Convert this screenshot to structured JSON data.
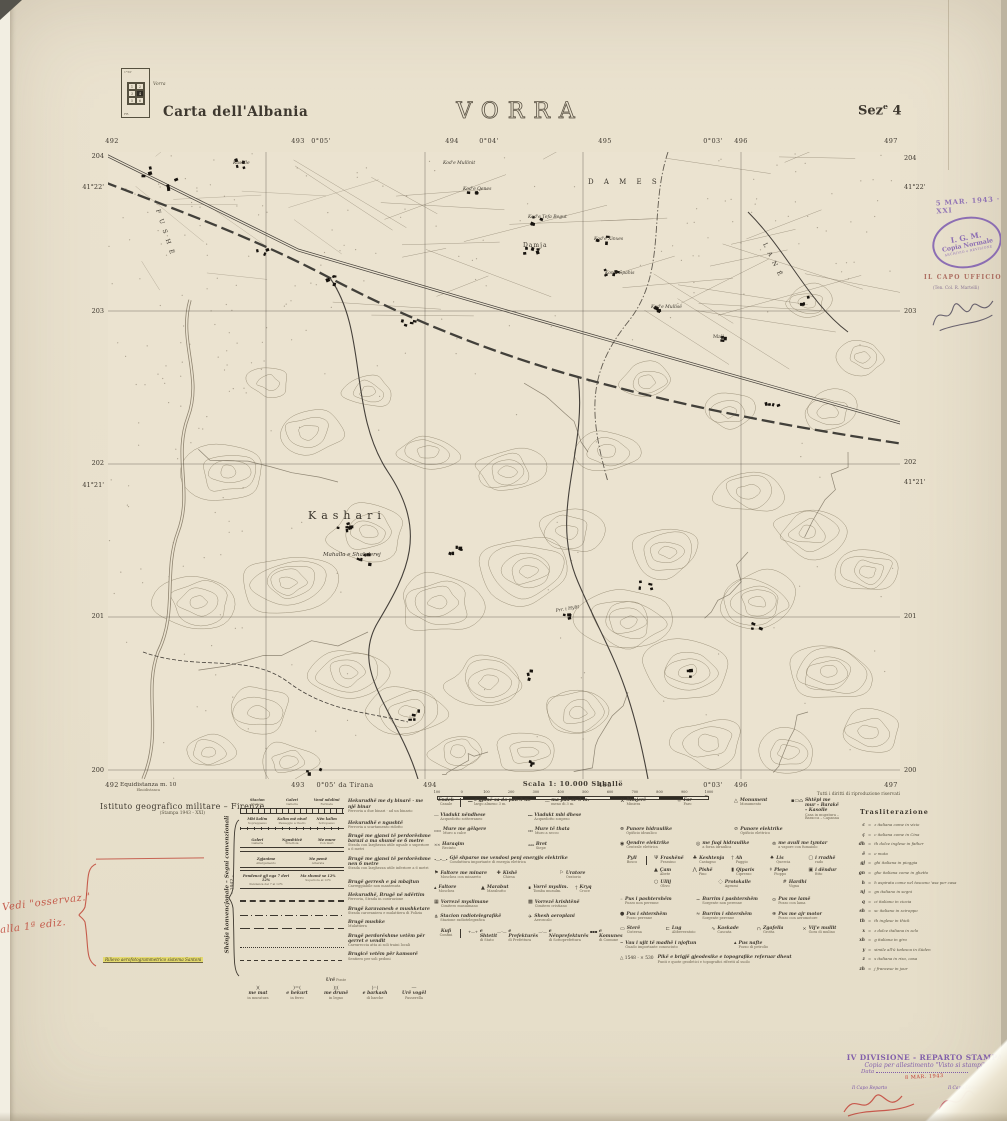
{
  "header": {
    "series_title": "Carta dell'Albania",
    "sheet_title": "VORRA",
    "sez_label": "Sez",
    "sez_sup": "e",
    "sez_num": "4",
    "index": {
      "label": "Vorra",
      "cells": [
        "1",
        "2",
        "3",
        "4",
        "5",
        "6"
      ],
      "selected": "4",
      "corner_top": "1°50'",
      "corner_bottom": "FR."
    }
  },
  "map_frame": {
    "top_labels": [
      {
        "t": "492",
        "x": 112
      },
      {
        "t": "493",
        "x": 298
      },
      {
        "t": "0°05'",
        "x": 321
      },
      {
        "t": "494",
        "x": 452
      },
      {
        "t": "0°04'",
        "x": 489
      },
      {
        "t": "495",
        "x": 605
      },
      {
        "t": "0°03'",
        "x": 713
      },
      {
        "t": "496",
        "x": 741
      },
      {
        "t": "497",
        "x": 891
      }
    ],
    "bottom_labels": [
      {
        "t": "492",
        "x": 112
      },
      {
        "t": "493",
        "x": 298
      },
      {
        "t": "0°05' da Tirana",
        "x": 345
      },
      {
        "t": "494",
        "x": 430
      },
      {
        "t": "495",
        "x": 605
      },
      {
        "t": "0°03'",
        "x": 713
      },
      {
        "t": "496",
        "x": 741
      },
      {
        "t": "497",
        "x": 891
      }
    ],
    "left_labels": [
      {
        "t": "204",
        "y": 152
      },
      {
        "t": "41°22'",
        "y": 183
      },
      {
        "t": "203",
        "y": 307
      },
      {
        "t": "202",
        "y": 459
      },
      {
        "t": "41°21'",
        "y": 481
      },
      {
        "t": "201",
        "y": 612
      },
      {
        "t": "200",
        "y": 766
      }
    ],
    "right_labels": [
      {
        "t": "204",
        "y": 154
      },
      {
        "t": "41°22'",
        "y": 183
      },
      {
        "t": "203",
        "y": 307
      },
      {
        "t": "202",
        "y": 458
      },
      {
        "t": "41°21'",
        "y": 478
      },
      {
        "t": "201",
        "y": 612
      },
      {
        "t": "200",
        "y": 766
      }
    ],
    "equidistance": "Equidistanza m. 10",
    "equidistance_sub": "Ekuidistanca",
    "scale_label": "Scala 1: 10.000 Shkallë",
    "scale_ticks": [
      "100",
      "0",
      "100",
      "200",
      "300",
      "400",
      "500",
      "600",
      "700",
      "800",
      "900",
      "1000 m."
    ],
    "rights": "Tutti i diritti di riproduzione riservati"
  },
  "map_labels": [
    {
      "t": "Kasolle",
      "x": 125,
      "y": 12,
      "s": 4.5,
      "it": true
    },
    {
      "t": "Kod'e Mullinit",
      "x": 335,
      "y": 12,
      "s": 4.5,
      "it": true
    },
    {
      "t": "Kod'e Qenes",
      "x": 355,
      "y": 38,
      "s": 4.5,
      "it": true
    },
    {
      "t": "Kod'e Tefa Begut",
      "x": 420,
      "y": 66,
      "s": 4.5,
      "it": true
    },
    {
      "t": "Damja",
      "x": 415,
      "y": 95,
      "s": 6,
      "sp": 1
    },
    {
      "t": "Kod'e Xinxes",
      "x": 486,
      "y": 88,
      "s": 4.5,
      "it": true
    },
    {
      "t": "Kon'e Spahis",
      "x": 497,
      "y": 122,
      "s": 4.5,
      "it": true
    },
    {
      "t": "Kod'e Mullisë",
      "x": 543,
      "y": 156,
      "s": 4.5,
      "it": true
    },
    {
      "t": "Mali",
      "x": 605,
      "y": 186,
      "s": 5
    },
    {
      "t": "D A M E S",
      "x": 480,
      "y": 32,
      "s": 7,
      "sp": 4
    },
    {
      "t": "F U S H Ë",
      "x": 48,
      "y": 58,
      "s": 6,
      "sp": 2,
      "rot": 72
    },
    {
      "t": "L A N Ë",
      "x": 655,
      "y": 92,
      "s": 6,
      "sp": 2,
      "rot": 64
    },
    {
      "t": "Kashari",
      "x": 200,
      "y": 367,
      "s": 11,
      "sp": 5
    },
    {
      "t": "Mahalla e Shabderej",
      "x": 215,
      "y": 404,
      "s": 5.5,
      "it": true
    },
    {
      "t": "Prr. i Hylit",
      "x": 448,
      "y": 460,
      "s": 4.5,
      "it": true,
      "rot": -10
    }
  ],
  "stamps": {
    "date_stamp": "5 MAR. 1943 · XXI",
    "oval_line1": "I. G. M.",
    "oval_line2": "Copia Normale",
    "oval_line3": "ARCHIVIO e REVISIONE",
    "capo_ufficio": "IL CAPO UFFICIO",
    "capo_ufficio_sub": "(Ten. Col. R. Martelli)",
    "print_line1": "IV DIVISIONE - REPARTO STAMPA",
    "print_line2": "Copia per allestimento \"Visto si stampi\"",
    "print_line3": "Data",
    "print_date": "8 MAR. 1943",
    "capo_reparto": "Il Capo Reparto",
    "capo_divisione": "Il Capo Divisione"
  },
  "publisher": {
    "line1": "Istituto geografico militare – Firenze",
    "line2": "(Stampa 1943 - XXI)"
  },
  "annotations": {
    "red_note_line1": "Vedi \"osservaz.\"",
    "red_note_line2": "alla 1ª ediz.",
    "yellow_note": "Rilievo aerofotogrammetrico sistema Santoni"
  },
  "legend": {
    "side_label": "Shënja konvencjonale – Segni convenzionali",
    "side_label2": "– 1942 –",
    "col1": [
      {
        "sym": "rail2",
        "marks": [
          {
            "a": "Stacion",
            "i": "Stazione"
          },
          {
            "a": "Galeri",
            "i": "Galleria"
          },
          {
            "a": "Vend ndalimi",
            "i": "Fermata"
          }
        ],
        "desc": {
          "a": "Hekurudhë me dy binarë · me një binar",
          "i": "Ferrovia a due binari · ad un binario"
        }
      },
      {
        "sym": "rail1",
        "marks": [
          {
            "a": "Mbi kalim",
            "i": "Soprappasso"
          },
          {
            "a": "Kalim më nivel",
            "i": "Passaggio a livello"
          },
          {
            "a": "Nën kalim",
            "i": "Sottopasso"
          }
        ],
        "desc": {
          "a": "Hekurudhë e ngushtë",
          "i": "Ferrovia a scartamento ridotto"
        }
      },
      {
        "sym": "road6",
        "marks": [
          {
            "a": "Galeri",
            "i": "Galleria"
          },
          {
            "a": "Ngushticë",
            "i": "Strettoia"
          },
          {
            "a": "Me mure",
            "i": "Con muri"
          }
        ],
        "desc": {
          "a": "Brugë me gjansi të perdorëshme barazi a ma shumë se 6 metre",
          "i": "Strada con larghezza utile uguale o superiore a 6 metri"
        }
      },
      {
        "sym": "road4",
        "marks": [
          {
            "a": "Zgjanime",
            "i": "Allargamento"
          },
          {
            "a": "Me pemë",
            "i": "Alberata"
          }
        ],
        "desc": {
          "a": "Brugë me gjansi të perdorëshme nen 6 metre",
          "i": "Strada con larghezza utile inferiore a 6 metri"
        }
      },
      {
        "sym": "road3",
        "marks": [
          {
            "a": "Pendencë gji nga 7 deri 12%",
            "i": "Pendenza dal 7 al 12%"
          },
          {
            "a": "Ma shumë se 12%",
            "i": "Superiore al 12%"
          }
        ],
        "desc": {
          "a": "Brugë gerresh e pá mbajtun",
          "i": "Carreggiabile non mantenuta"
        }
      },
      {
        "sym": "dashbig",
        "desc": {
          "a": "Hekurudhë, Brugë në ndërtim",
          "i": "Ferrovia, Strada in costruzione"
        }
      },
      {
        "sym": "dashdot",
        "desc": {
          "a": "Brugë karavanesh e mushketare",
          "i": "Strada carovaniera e mulattiera di Polizia"
        }
      },
      {
        "sym": "longdash",
        "desc": {
          "a": "Brugë mushke",
          "i": "Mulattiera"
        }
      },
      {
        "sym": "dotline",
        "desc": {
          "a": "Brugë perdorëshme vetëm për qerret e vendit",
          "i": "Carrareccia atta ai soli traini locali"
        }
      },
      {
        "sym": "finedash",
        "desc": {
          "a": "Brugicë vetëm për kamsorë",
          "i": "Sentiero per soli pedoni"
        }
      },
      {
        "bridge": {
          "t": {
            "a": "Urë",
            "i": "Ponte"
          },
          "items": [
            {
              "g": ")(",
              "a": "me mat",
              "i": "in muratura"
            },
            {
              "g": ")=(",
              "a": "e hekurt",
              "i": "in ferro"
            },
            {
              "g": ")¦(",
              "a": "me drunë",
              "i": "in legno"
            },
            {
              "g": ")◦(",
              "a": "e barkash",
              "i": "di barche"
            },
            {
              "g": "—",
              "a": "Urë vogël",
              "i": "Passerella"
            }
          ]
        }
      }
    ],
    "col2": [
      {
        "t": {
          "a": "Endek",
          "i": "Canale"
        },
        "items": [
          {
            "smp": "━━",
            "a": "e gjanë sa do pak 3 m.",
            "i": "largo almeno 3 m."
          },
          {
            "smp": "──",
            "a": "ma pak se 3 m.",
            "i": "meno di 3 m."
          }
        ]
      },
      {
        "items": [
          {
            "smp": "┄┄",
            "a": "Viadukt nëndhese",
            "i": "Acquedotto sotterraneo"
          },
          {
            "smp": "╍╍",
            "a": "Viadukt mbi dhese",
            "i": "Acquedotto sospeso"
          }
        ]
      },
      {
        "items": [
          {
            "smp": "▭▭",
            "a": "Mure me gëlqere",
            "i": "Muro a calce"
          },
          {
            "smp": "▫▫",
            "a": "Mure të thata",
            "i": "Muro a secco"
          }
        ]
      },
      {
        "items": [
          {
            "smp": "××",
            "a": "Haraqim",
            "i": "Recinto"
          },
          {
            "smp": "ʌʌʌ",
            "a": "Bret",
            "i": "Siepe"
          }
        ]
      },
      {
        "items": [
          {
            "smp": "•—•—•",
            "a": "Gjë shparse me vendosi penj energjis elektrike",
            "i": "Conduttura importante di energia elettrica"
          }
        ]
      },
      {
        "items": [
          {
            "g": "⚑",
            "a": "Faltore me minare",
            "i": "Moschea con minareto"
          },
          {
            "g": "✚",
            "a": "Kishë",
            "i": "Chiesa"
          },
          {
            "g": "⚐",
            "a": "Uratore",
            "i": "Oratorio"
          }
        ]
      },
      {
        "items": [
          {
            "g": "▴",
            "a": "Faltore",
            "i": "Moschea"
          },
          {
            "g": "▲",
            "a": "Marabut",
            "i": "Marabutto"
          },
          {
            "g": "∎",
            "a": "Vorrë myslim.",
            "i": "Tomba musulm."
          },
          {
            "g": "†",
            "a": "Kryq",
            "i": "Croce"
          }
        ]
      },
      {
        "items": [
          {
            "g": "▦",
            "a": "Vorrezë myslimane",
            "i": "Cimitero musulmano"
          },
          {
            "g": "▩",
            "a": "Vorrezë krishtënë",
            "i": "Cimitero cristiano"
          }
        ]
      },
      {
        "items": [
          {
            "g": "⋔",
            "a": "Stacion radiotelegrafikë",
            "i": "Stazione radiotelegrafica"
          },
          {
            "g": "✈",
            "a": "Shesh aeroplani",
            "i": "Aeroscalo"
          }
        ]
      },
      {
        "t": {
          "a": "Kufi",
          "i": "Confini"
        },
        "items": [
          {
            "smp": "+—+",
            "a": "e Shtetit",
            "i": "di Stato"
          },
          {
            "smp": "—··—",
            "a": "e Prefekturës",
            "i": "di Prefettura"
          },
          {
            "smp": "—·—",
            "a": "e Nënprefekturës",
            "i": "di Sottoprefettura"
          },
          {
            "smp": "▪▪▪",
            "a": "e Komunes",
            "i": "di Comune"
          }
        ]
      }
    ],
    "col3": [
      {
        "items": [
          {
            "g": "⚒",
            "a": "Minjerë",
            "i": "Miniera"
          },
          {
            "g": "☼",
            "a": "Far",
            "i": "Faro"
          },
          {
            "g": "△",
            "a": "Monument",
            "i": "Monumento"
          },
          {
            "g": "▪▭⌂",
            "a": "Shtëpi me mur – Barakë – Kasolle",
            "i": "Casa in muratura – Baracca – Capanna"
          }
        ]
      },
      {
        "items": [
          {
            "g": "⊗",
            "a": "Punore hidraulike",
            "i": "Opificio idraulico"
          },
          {
            "g": "⊘",
            "a": "Punore elektrike",
            "i": "Opificio elettrico"
          }
        ]
      },
      {
        "items": [
          {
            "g": "◉",
            "a": "Qendre elektrike",
            "i": "Centrale elettrica"
          },
          {
            "g": "◎",
            "a": "me fuqi hidraulike",
            "i": "a forza idraulica"
          },
          {
            "g": "⊚",
            "a": "me avull me tymtar",
            "i": "a vapore con fumaiolo"
          }
        ]
      },
      {
        "t": {
          "a": "Pyll",
          "i": "Bosco"
        },
        "tree_rows": [
          [
            {
              "g": "Ψ",
              "a": "Frashënë",
              "i": "Frassino"
            },
            {
              "g": "♣",
              "a": "Keshtenja",
              "i": "Castagno"
            },
            {
              "g": "†",
              "a": "Ah",
              "i": "Faggio"
            },
            {
              "g": "♠",
              "a": "Lis",
              "i": "Quercia"
            },
            {
              "g": "▢",
              "a": "i rradhë",
              "i": "rado"
            }
          ],
          [
            {
              "g": "▲",
              "a": "Çam",
              "i": "Abete"
            },
            {
              "g": "⋀",
              "a": "Pishë",
              "i": "Pino"
            },
            {
              "g": "▮",
              "a": "Qiparis",
              "i": "Cipresso"
            },
            {
              "g": "ǂ",
              "a": "Plepe",
              "i": "Pioppo"
            },
            {
              "g": "▣",
              "a": "i dëndur",
              "i": "fitto"
            }
          ],
          [
            {
              "g": "○",
              "a": "Ullij",
              "i": "Olivo"
            },
            {
              "g": "◌",
              "a": "Protokalle",
              "i": "Agrumi"
            },
            {
              "g": "#",
              "a": "Hardhi",
              "i": "Vigna"
            }
          ]
        ]
      },
      {
        "items": [
          {
            "g": "◦",
            "a": "Pus i pashtershëm",
            "i": "Pozzo non perenne"
          },
          {
            "g": "~",
            "a": "Burrim i pashtershëm",
            "i": "Sorgente non perenne"
          },
          {
            "g": "⊙",
            "a": "Pus me lamë",
            "i": "Pozzo con lama"
          }
        ]
      },
      {
        "items": [
          {
            "g": "●",
            "a": "Pus i shtershëm",
            "i": "Pozzo perenne"
          },
          {
            "g": "≈",
            "a": "Burrim i shtershëm",
            "i": "Sorgente perenne"
          },
          {
            "g": "⊛",
            "a": "Pus me ajr motor",
            "i": "Pozzo con aeromotore"
          }
        ]
      },
      {
        "items": [
          {
            "g": "▭",
            "a": "Sterë",
            "i": "Cisterna"
          },
          {
            "g": "⊏",
            "a": "Lug",
            "i": "Abbeveratoio"
          },
          {
            "g": "∿",
            "a": "Kaskade",
            "i": "Cascata"
          },
          {
            "g": "∩",
            "a": "Zgafella",
            "i": "Grotta"
          },
          {
            "g": "×",
            "a": "Vij'e mullit",
            "i": "Gora di mulino"
          }
        ]
      },
      {
        "items": [
          {
            "g": "⌣",
            "a": "Vau i ujit të madhë i njoftun",
            "i": "Guado importante conosciuto"
          },
          {
            "g": "▴",
            "a": "Pus nafte",
            "i": "Pozzo di petrolio"
          }
        ]
      },
      {
        "geo": {
          "prefix": "△ 1548 · × 530",
          "a": "Pikë e brigjë gjeodesike e topografike referuar dheut",
          "i": "Punti e quote geodetici e topografici riferiti al suolo"
        }
      }
    ],
    "transliteration_title": "Trasliterazione",
    "transliteration": [
      {
        "l": "c",
        "d": "z italiana come in vizio"
      },
      {
        "l": "ç",
        "d": "c italiana come in Cina"
      },
      {
        "l": "dh",
        "d": "th dolce inglese in father"
      },
      {
        "l": "ë",
        "d": "e muta"
      },
      {
        "l": "gj",
        "d": "ghi italiana in pioggia"
      },
      {
        "l": "gn",
        "d": "ghe italiana come in ghetto"
      },
      {
        "l": "h",
        "d": "h aspirata come nel toscano 'asa per casa"
      },
      {
        "l": "nj",
        "d": "gn italiano in segni"
      },
      {
        "l": "q",
        "d": "ci italiano in ciocia"
      },
      {
        "l": "sh",
        "d": "sc italiano in sciroppo"
      },
      {
        "l": "th",
        "d": "th inglese in thick"
      },
      {
        "l": "x",
        "d": "z dolce italiana in zelo"
      },
      {
        "l": "xh",
        "d": "g italiana in giro"
      },
      {
        "l": "y",
        "d": "simile all'ü tedesca in Süden"
      },
      {
        "l": "z",
        "d": "s italiana in riso, casa"
      },
      {
        "l": "zh",
        "d": "j francese in jour"
      }
    ]
  },
  "colors": {
    "paper": "#e8e0cc",
    "ink": "#3e382f",
    "contour": "#8c8169",
    "stamp_purple": "#7d5bb0",
    "note_red": "#bf4536",
    "highlight_yellow": "#e4da6e"
  }
}
